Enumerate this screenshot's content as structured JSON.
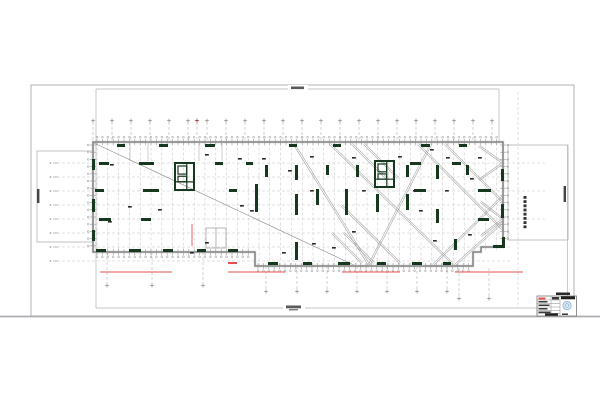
{
  "sheet": {
    "kind": "structural-floor-plan-drawing",
    "background": "#ffffff",
    "colors": {
      "border_outer": "#b7b7ba",
      "divider": "#aeaeb2",
      "frame_inner": "#b3b3b5",
      "edge_dark": "#6a6a6a",
      "edge_halo": "#cccccc",
      "grid": "#c4c4c4",
      "tick": "#8f8f8f",
      "stub": "#a6a6a6",
      "wall_green": "#17381f",
      "brace": "#a0a0a0",
      "diag": "#8a8a8a",
      "partition": "#b8b8b8",
      "red": "#e4504f",
      "maroon": "#8c2a22",
      "ink": "#1f1f1f",
      "smudge": "#2a2a2a",
      "stamp_fill": "#dbe7f3",
      "stamp_stroke": "#8fb4d8"
    }
  },
  "frames": {
    "outer": [
      31,
      85,
      543,
      231
    ],
    "divider_y": 316.5,
    "inner_segments": [
      [
        96,
        89,
        499,
        89
      ],
      [
        96,
        89,
        96,
        308
      ],
      [
        96,
        308,
        567,
        308
      ],
      [
        499,
        89,
        499,
        141
      ],
      [
        567.5,
        145,
        567.5,
        308
      ]
    ],
    "left_box": [
      37,
      151,
      56,
      91
    ],
    "right_box": [
      508,
      145,
      60,
      95
    ]
  },
  "plan": {
    "outline": [
      [
        93,
        142
      ],
      [
        503,
        142
      ],
      [
        503,
        247
      ],
      [
        481,
        247
      ],
      [
        481,
        252
      ],
      [
        473,
        252
      ],
      [
        473,
        266
      ],
      [
        255,
        266
      ],
      [
        255,
        252
      ],
      [
        93,
        252
      ]
    ],
    "minor_grid": {
      "x0": 97,
      "step": 10.8,
      "count": 38,
      "y_top": 142.5,
      "y_bot": 252,
      "y_bot_prot": 266,
      "prot_x1": 255,
      "prot_x2": 473
    },
    "rows": [
      163,
      177,
      191,
      205,
      219,
      233,
      247,
      261
    ],
    "rows_extended": [
      163,
      191,
      219
    ],
    "row_x1": 57,
    "row_x2": 512,
    "row_x2_ext": 547,
    "stubs_top": [
      93,
      112,
      131,
      150,
      169,
      188,
      207,
      226,
      245,
      264,
      283,
      302,
      321,
      340,
      359,
      378,
      397,
      416,
      435,
      454,
      473,
      492
    ],
    "stub_maroon_x": 197,
    "stubs_bottom_left": [
      107,
      152,
      203
    ],
    "stubs_bottom_mid": [
      266,
      297,
      327,
      357,
      387,
      417,
      447
    ],
    "stubs_bottom_right": [
      459,
      489
    ],
    "long_grid_x": 518,
    "diag_single": [
      94,
      143,
      356,
      266
    ],
    "braces": [
      [
        294,
        144,
        369,
        265
      ],
      [
        369,
        265,
        431,
        144
      ],
      [
        330,
        144,
        452,
        263
      ],
      [
        341,
        205,
        400,
        263
      ],
      [
        418,
        144,
        503,
        230
      ],
      [
        445,
        144,
        503,
        202
      ],
      [
        433,
        265,
        503,
        196
      ],
      [
        455,
        265,
        503,
        222
      ],
      [
        503,
        163,
        479,
        146
      ],
      [
        503,
        163,
        479,
        180
      ],
      [
        503,
        219,
        481,
        202
      ],
      [
        503,
        219,
        481,
        236
      ],
      [
        352,
        144,
        386,
        178
      ],
      [
        364,
        144,
        398,
        178
      ],
      [
        332,
        233,
        362,
        263
      ],
      [
        344,
        233,
        374,
        263
      ]
    ],
    "walls": [
      [
        117,
        144,
        8,
        3
      ],
      [
        159,
        144,
        9,
        3
      ],
      [
        205,
        144,
        10,
        3
      ],
      [
        289,
        144,
        8,
        3
      ],
      [
        333,
        144,
        8,
        3
      ],
      [
        421,
        144,
        9,
        3
      ],
      [
        459,
        144,
        8,
        3
      ],
      [
        99,
        162,
        10,
        3
      ],
      [
        139,
        162,
        15,
        3
      ],
      [
        215,
        162,
        8,
        3
      ],
      [
        246,
        162,
        7,
        3
      ],
      [
        410,
        162,
        11,
        3
      ],
      [
        452,
        162,
        9,
        3
      ],
      [
        95,
        189,
        9,
        3
      ],
      [
        143,
        189,
        16,
        3
      ],
      [
        229,
        189,
        8,
        3
      ],
      [
        414,
        189,
        12,
        3
      ],
      [
        478,
        189,
        13,
        3
      ],
      [
        99,
        218,
        12,
        3
      ],
      [
        141,
        218,
        10,
        3
      ],
      [
        478,
        218,
        11,
        3
      ],
      [
        96,
        249,
        10,
        3
      ],
      [
        129,
        249,
        12,
        3
      ],
      [
        163,
        249,
        10,
        3
      ],
      [
        197,
        249,
        9,
        3
      ],
      [
        228,
        249,
        10,
        3
      ],
      [
        268,
        262,
        10,
        3
      ],
      [
        303,
        262,
        9,
        3
      ],
      [
        338,
        262,
        12,
        3
      ],
      [
        377,
        262,
        9,
        3
      ],
      [
        412,
        262,
        10,
        3
      ],
      [
        443,
        262,
        8,
        3
      ],
      [
        255,
        184,
        3,
        28
      ],
      [
        265,
        165,
        3,
        12
      ],
      [
        295,
        165,
        3,
        15
      ],
      [
        295,
        194,
        3,
        21
      ],
      [
        295,
        242,
        3,
        18
      ],
      [
        316,
        189,
        3,
        16
      ],
      [
        326,
        165,
        3,
        10
      ],
      [
        345,
        189,
        3,
        26
      ],
      [
        356,
        165,
        3,
        12
      ],
      [
        376,
        194,
        3,
        18
      ],
      [
        406,
        165,
        3,
        12
      ],
      [
        406,
        194,
        3,
        16
      ],
      [
        436,
        165,
        3,
        14
      ],
      [
        436,
        209,
        3,
        14
      ],
      [
        454,
        239,
        3,
        11
      ],
      [
        466,
        165,
        3,
        10
      ],
      [
        92,
        159,
        3,
        11
      ],
      [
        92,
        199,
        3,
        13
      ],
      [
        92,
        230,
        3,
        11
      ],
      [
        501,
        169,
        3,
        12
      ],
      [
        501,
        204,
        3,
        14
      ],
      [
        493,
        245,
        11,
        3
      ],
      [
        502,
        237,
        3,
        11
      ]
    ],
    "cores": [
      [
        175,
        163,
        19,
        27
      ],
      [
        375,
        161,
        19,
        26
      ]
    ],
    "partitions": [
      [
        130,
        142,
        130,
        161
      ],
      [
        148,
        142,
        148,
        161
      ],
      [
        199,
        142,
        199,
        161
      ],
      [
        222,
        142,
        222,
        161
      ]
    ],
    "room": [
      206,
      228,
      20,
      20
    ]
  },
  "reds": {
    "underlines": [
      [
        100,
        272,
        72
      ],
      [
        228,
        272,
        57
      ],
      [
        342,
        272,
        58
      ],
      [
        455,
        272,
        68
      ]
    ],
    "vline": [
      192,
      224,
      22
    ],
    "microtext": [
      228,
      262,
      9,
      2
    ]
  },
  "annotations": {
    "microtext_legible": false,
    "smudges": [
      [
        205,
        154
      ],
      [
        238,
        158
      ],
      [
        262,
        158
      ],
      [
        310,
        156
      ],
      [
        352,
        157
      ],
      [
        398,
        156
      ],
      [
        430,
        149
      ],
      [
        446,
        157
      ],
      [
        470,
        178
      ],
      [
        419,
        210
      ],
      [
        352,
        231
      ],
      [
        312,
        243
      ],
      [
        282,
        252
      ],
      [
        332,
        247
      ],
      [
        433,
        240
      ],
      [
        468,
        234
      ],
      [
        110,
        164
      ],
      [
        108,
        221
      ],
      [
        128,
        206
      ],
      [
        158,
        209
      ],
      [
        205,
        242
      ],
      [
        250,
        210
      ],
      [
        362,
        190
      ],
      [
        310,
        190
      ],
      [
        413,
        190
      ],
      [
        478,
        157
      ],
      [
        445,
        190
      ],
      [
        288,
        170
      ],
      [
        240,
        205
      ],
      [
        190,
        252
      ]
    ],
    "frame_label_top": [
      288,
      85,
      20,
      7
    ],
    "frame_label_bottom": [
      283,
      304,
      22,
      8
    ],
    "left_box_text": [
      37,
      189,
      2.4,
      14
    ],
    "right_box_text": [
      563.6,
      186,
      2.4,
      16
    ],
    "right_stack_text": {
      "x": 523.5,
      "y0": 196,
      "dy": 4.2,
      "n": 8,
      "w": 3,
      "h": 2.8
    },
    "above_title_text": [
      556,
      292.5,
      14,
      2.5
    ]
  },
  "title_block": {
    "box": [
      537,
      296,
      39.5,
      20
    ],
    "col_x": [
      551,
      560
    ],
    "row_ys": [
      300,
      303.5,
      307,
      310.5,
      313.5
    ],
    "red_text": [
      538.5,
      297.5,
      7,
      2
    ],
    "dark_bars": [
      [
        552,
        297,
        7,
        2.5
      ],
      [
        538.5,
        301,
        9,
        1.5
      ],
      [
        538.5,
        304.5,
        11,
        1.5
      ],
      [
        538.5,
        308,
        9,
        1.5
      ],
      [
        538.5,
        311.5,
        12,
        1.5
      ],
      [
        562,
        313.5,
        6,
        1.5
      ]
    ],
    "black_bars": [
      [
        561,
        296.3,
        14,
        3
      ],
      [
        545,
        313.3,
        13,
        2.4
      ]
    ],
    "stamp": {
      "cx": 567,
      "cy": 305.5,
      "r": 4.2
    }
  }
}
